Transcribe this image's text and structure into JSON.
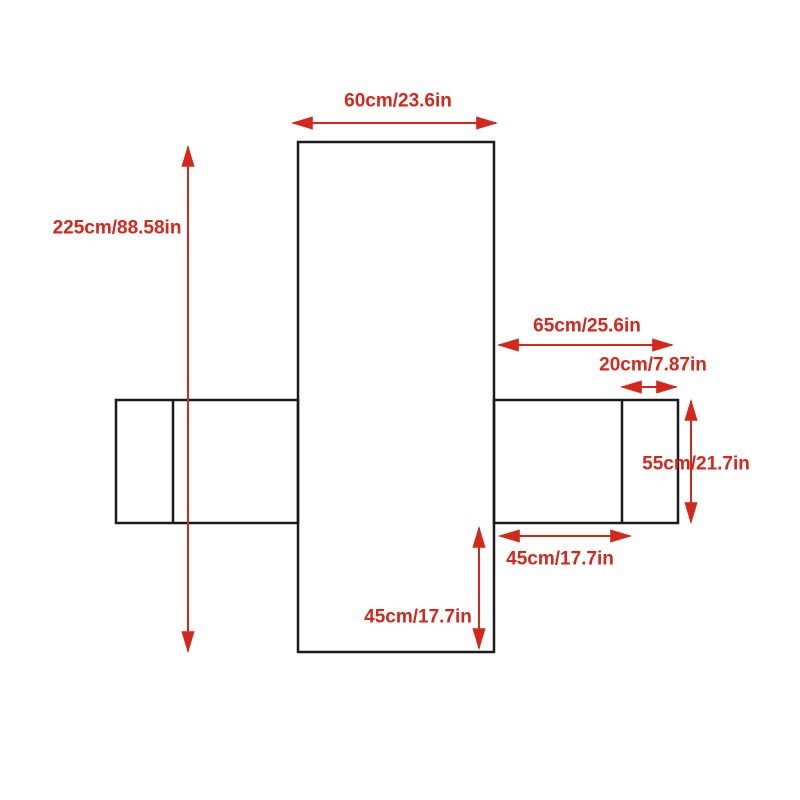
{
  "diagram": {
    "title": "sofa-cover-flat-dimension-diagram",
    "background_color": "#ffffff",
    "outline_color": "#1a1a1a",
    "dimension_color": "#d3281c",
    "labels": {
      "top_width": "60cm/23.6in",
      "total_height": "225cm/88.58in",
      "right_wing_width": "65cm/25.6in",
      "right_flap_width": "20cm/7.87in",
      "right_wing_height": "55cm/21.7in",
      "right_wing_bottom_width": "45cm/17.7in",
      "bottom_drop_height": "45cm/17.7in"
    }
  }
}
